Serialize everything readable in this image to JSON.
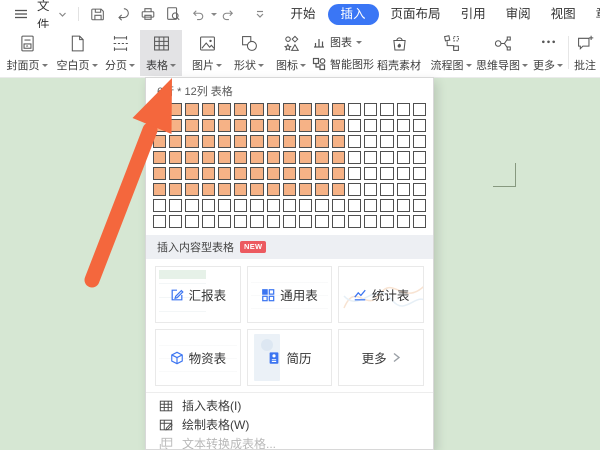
{
  "colors": {
    "accent_blue": "#3a76f5",
    "doc_green": "#d6e7d3",
    "cell_orange": "#f6b286",
    "badge_red": "#ec5a60",
    "icon_blue": "#3c75f1",
    "arrow_orange": "#f4673d"
  },
  "titlebar": {
    "menu_label": "文件",
    "tabs": [
      {
        "label": "开始",
        "active": false
      },
      {
        "label": "插入",
        "active": true
      },
      {
        "label": "页面布局",
        "active": false
      },
      {
        "label": "引用",
        "active": false
      },
      {
        "label": "审阅",
        "active": false
      },
      {
        "label": "视图",
        "active": false
      },
      {
        "label": "章节",
        "active": false
      },
      {
        "label": "开发工具",
        "active": false
      }
    ]
  },
  "ribbon": {
    "items": [
      {
        "label": "封面页",
        "icon": "cover-page-icon"
      },
      {
        "label": "空白页",
        "icon": "blank-page-icon"
      },
      {
        "label": "分页",
        "icon": "page-break-icon"
      },
      {
        "label": "表格",
        "icon": "table-icon",
        "active": true
      },
      {
        "label": "图片",
        "icon": "picture-icon"
      },
      {
        "label": "形状",
        "icon": "shapes-icon"
      },
      {
        "label": "图标",
        "icon": "icons-icon"
      },
      {
        "label": "图表",
        "icon": "chart-icon"
      },
      {
        "label": "智能图形",
        "icon": "smart-graphics-icon"
      },
      {
        "label": "稻壳素材",
        "icon": "docer-assets-icon"
      },
      {
        "label": "流程图",
        "icon": "flowchart-icon"
      },
      {
        "label": "思维导图",
        "icon": "mindmap-icon"
      },
      {
        "label": "更多",
        "icon": "more-dots-icon"
      },
      {
        "label": "批注",
        "icon": "comment-icon"
      }
    ]
  },
  "table_dropdown": {
    "grid_header": "6行 * 12列 表格",
    "grid": {
      "cols": 17,
      "rows": 8,
      "selected_cols": 12,
      "selected_rows": 6
    },
    "section_title": "插入内容型表格",
    "badge": "NEW",
    "cards": [
      {
        "label": "汇报表",
        "icon": "report-table-icon"
      },
      {
        "label": "通用表",
        "icon": "general-table-icon"
      },
      {
        "label": "统计表",
        "icon": "stats-table-icon"
      },
      {
        "label": "物资表",
        "icon": "supplies-table-icon"
      },
      {
        "label": "简历",
        "icon": "resume-icon"
      },
      {
        "label": "更多",
        "icon": "chevron-right-icon"
      }
    ],
    "menu_items": [
      {
        "label": "插入表格(I)",
        "icon": "insert-table-icon",
        "disabled": false
      },
      {
        "label": "绘制表格(W)",
        "icon": "draw-table-icon",
        "disabled": false
      },
      {
        "label": "文本转换成表格...",
        "icon": "convert-text-table-icon",
        "disabled": true
      }
    ]
  }
}
